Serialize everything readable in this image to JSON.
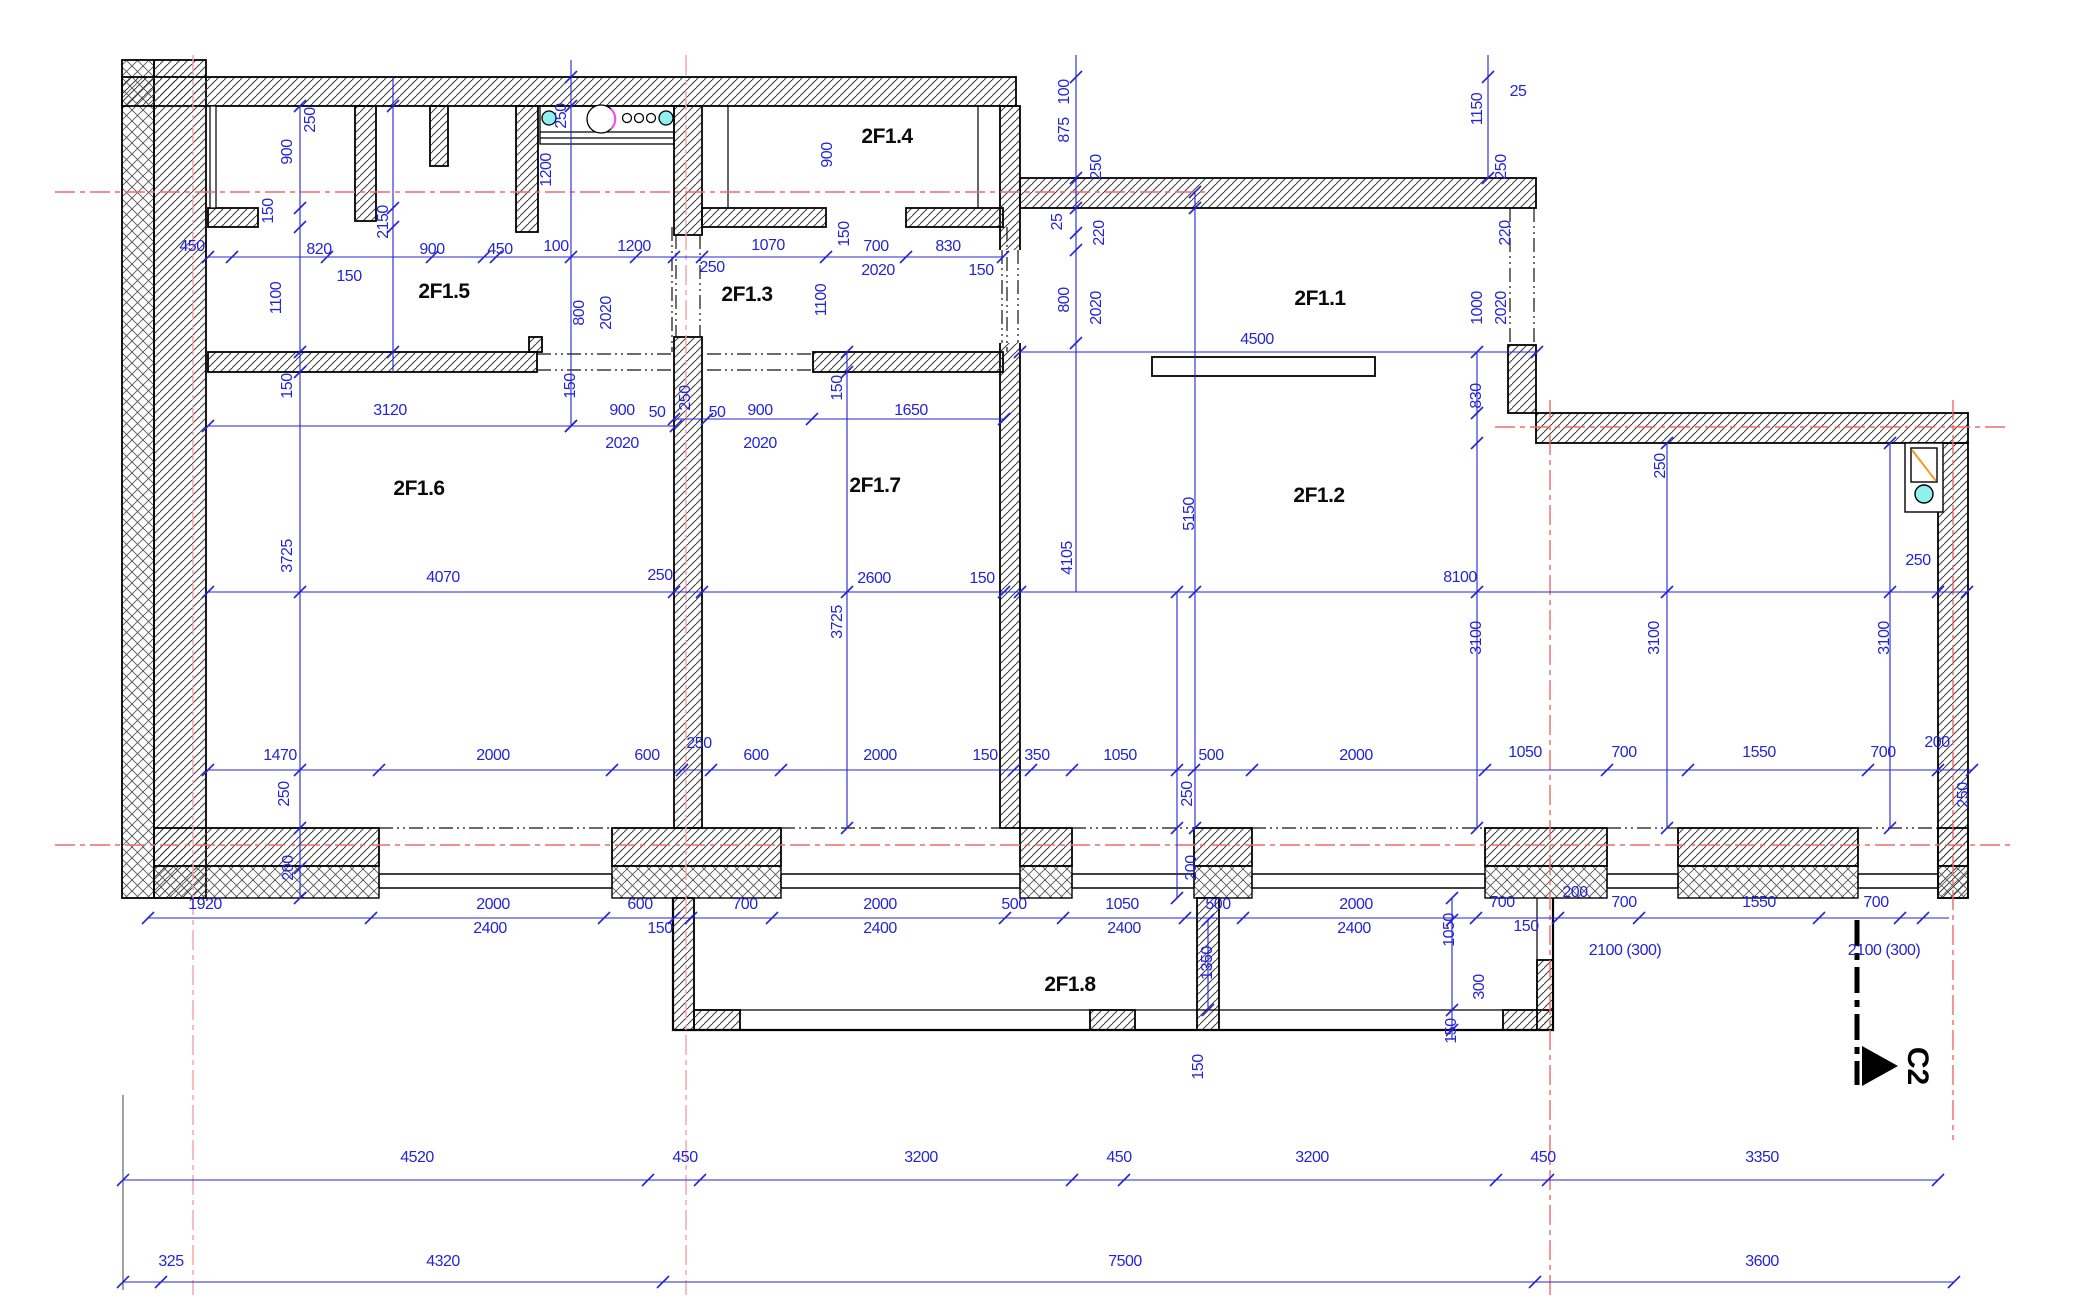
{
  "drawing": {
    "section_marker_label": "C2",
    "room_labels": [
      {
        "name": "2F1.1",
        "x": 1320,
        "y": 299
      },
      {
        "name": "2F1.2",
        "x": 1319,
        "y": 496
      },
      {
        "name": "2F1.3",
        "x": 747,
        "y": 295
      },
      {
        "name": "2F1.4",
        "x": 887,
        "y": 137
      },
      {
        "name": "2F1.5",
        "x": 444,
        "y": 292
      },
      {
        "name": "2F1.6",
        "x": 419,
        "y": 489
      },
      {
        "name": "2F1.7",
        "x": 875,
        "y": 486
      },
      {
        "name": "2F1.8",
        "x": 1070,
        "y": 985
      }
    ],
    "dim_labels": [
      {
        "t": "450",
        "x": 192,
        "y": 247
      },
      {
        "t": "900",
        "x": 288,
        "y": 152,
        "v": 1
      },
      {
        "t": "250",
        "x": 311,
        "y": 120,
        "v": 1
      },
      {
        "t": "150",
        "x": 269,
        "y": 211,
        "v": 1
      },
      {
        "t": "820",
        "x": 319,
        "y": 250
      },
      {
        "t": "150",
        "x": 349,
        "y": 277
      },
      {
        "t": "2150",
        "x": 384,
        "y": 222,
        "v": 1
      },
      {
        "t": "900",
        "x": 432,
        "y": 250
      },
      {
        "t": "450",
        "x": 500,
        "y": 250
      },
      {
        "t": "100",
        "x": 556,
        "y": 247
      },
      {
        "t": "1200",
        "x": 634,
        "y": 247
      },
      {
        "t": "1200",
        "x": 547,
        "y": 170,
        "v": 1
      },
      {
        "t": "250",
        "x": 562,
        "y": 116,
        "v": 1
      },
      {
        "t": "1100",
        "x": 277,
        "y": 298,
        "v": 1
      },
      {
        "t": "250",
        "x": 712,
        "y": 268
      },
      {
        "t": "1070",
        "x": 768,
        "y": 246
      },
      {
        "t": "150",
        "x": 845,
        "y": 234,
        "v": 1
      },
      {
        "t": "700",
        "x": 876,
        "y": 247
      },
      {
        "t": "2020",
        "x": 878,
        "y": 271
      },
      {
        "t": "830",
        "x": 948,
        "y": 247
      },
      {
        "t": "150",
        "x": 981,
        "y": 271
      },
      {
        "t": "900",
        "x": 828,
        "y": 155,
        "v": 1
      },
      {
        "t": "1100",
        "x": 822,
        "y": 300,
        "v": 1
      },
      {
        "t": "800",
        "x": 580,
        "y": 313,
        "v": 1
      },
      {
        "t": "2020",
        "x": 607,
        "y": 313,
        "v": 1
      },
      {
        "t": "150",
        "x": 288,
        "y": 386,
        "v": 1
      },
      {
        "t": "3120",
        "x": 390,
        "y": 411
      },
      {
        "t": "900",
        "x": 622,
        "y": 411
      },
      {
        "t": "50",
        "x": 657,
        "y": 413
      },
      {
        "t": "2020",
        "x": 622,
        "y": 444
      },
      {
        "t": "150",
        "x": 571,
        "y": 386,
        "v": 1
      },
      {
        "t": "4070",
        "x": 443,
        "y": 578
      },
      {
        "t": "250",
        "x": 660,
        "y": 576
      },
      {
        "t": "3725",
        "x": 288,
        "y": 556,
        "v": 1
      },
      {
        "t": "250",
        "x": 686,
        "y": 398,
        "v": 1
      },
      {
        "t": "50",
        "x": 717,
        "y": 413
      },
      {
        "t": "900",
        "x": 760,
        "y": 411
      },
      {
        "t": "2020",
        "x": 760,
        "y": 444
      },
      {
        "t": "150",
        "x": 838,
        "y": 388,
        "v": 1
      },
      {
        "t": "1650",
        "x": 911,
        "y": 411
      },
      {
        "t": "2600",
        "x": 874,
        "y": 579
      },
      {
        "t": "150",
        "x": 982,
        "y": 579
      },
      {
        "t": "3725",
        "x": 838,
        "y": 622,
        "v": 1
      },
      {
        "t": "4105",
        "x": 1068,
        "y": 558,
        "v": 1
      },
      {
        "t": "100",
        "x": 1065,
        "y": 92,
        "v": 1
      },
      {
        "t": "875",
        "x": 1065,
        "y": 130,
        "v": 1
      },
      {
        "t": "250",
        "x": 1097,
        "y": 167,
        "v": 1
      },
      {
        "t": "25",
        "x": 1058,
        "y": 222,
        "v": 1
      },
      {
        "t": "220",
        "x": 1100,
        "y": 233,
        "v": 1
      },
      {
        "t": "800",
        "x": 1065,
        "y": 300,
        "v": 1
      },
      {
        "t": "2020",
        "x": 1097,
        "y": 308,
        "v": 1
      },
      {
        "t": "4500",
        "x": 1257,
        "y": 340
      },
      {
        "t": "1150",
        "x": 1478,
        "y": 109,
        "v": 1
      },
      {
        "t": "25",
        "x": 1518,
        "y": 92
      },
      {
        "t": "250",
        "x": 1502,
        "y": 167,
        "v": 1
      },
      {
        "t": "220",
        "x": 1506,
        "y": 233,
        "v": 1
      },
      {
        "t": "1000",
        "x": 1478,
        "y": 308,
        "v": 1
      },
      {
        "t": "2020",
        "x": 1502,
        "y": 308,
        "v": 1
      },
      {
        "t": "830",
        "x": 1477,
        "y": 396,
        "v": 1
      },
      {
        "t": "250",
        "x": 1661,
        "y": 466,
        "v": 1
      },
      {
        "t": "5150",
        "x": 1190,
        "y": 514,
        "v": 1
      },
      {
        "t": "8100",
        "x": 1460,
        "y": 578
      },
      {
        "t": "250",
        "x": 1918,
        "y": 561
      },
      {
        "t": "3100",
        "x": 1477,
        "y": 638,
        "v": 1
      },
      {
        "t": "3100",
        "x": 1655,
        "y": 638,
        "v": 1
      },
      {
        "t": "3100",
        "x": 1885,
        "y": 638,
        "v": 1
      },
      {
        "t": "1470",
        "x": 280,
        "y": 756
      },
      {
        "t": "2000",
        "x": 493,
        "y": 756
      },
      {
        "t": "600",
        "x": 647,
        "y": 756
      },
      {
        "t": "250",
        "x": 699,
        "y": 744
      },
      {
        "t": "600",
        "x": 756,
        "y": 756
      },
      {
        "t": "2000",
        "x": 880,
        "y": 756
      },
      {
        "t": "150",
        "x": 985,
        "y": 756
      },
      {
        "t": "350",
        "x": 1037,
        "y": 756
      },
      {
        "t": "1050",
        "x": 1120,
        "y": 756
      },
      {
        "t": "500",
        "x": 1211,
        "y": 756
      },
      {
        "t": "2000",
        "x": 1356,
        "y": 756
      },
      {
        "t": "1050",
        "x": 1525,
        "y": 753
      },
      {
        "t": "700",
        "x": 1624,
        "y": 753
      },
      {
        "t": "1550",
        "x": 1759,
        "y": 753
      },
      {
        "t": "700",
        "x": 1883,
        "y": 753
      },
      {
        "t": "200",
        "x": 1937,
        "y": 743
      },
      {
        "t": "250",
        "x": 1964,
        "y": 795,
        "v": 1
      },
      {
        "t": "250",
        "x": 285,
        "y": 794,
        "v": 1
      },
      {
        "t": "200",
        "x": 289,
        "y": 868,
        "v": 1
      },
      {
        "t": "250",
        "x": 1188,
        "y": 794,
        "v": 1
      },
      {
        "t": "200",
        "x": 1192,
        "y": 868,
        "v": 1
      },
      {
        "t": "1920",
        "x": 205,
        "y": 905
      },
      {
        "t": "2000",
        "x": 493,
        "y": 905
      },
      {
        "t": "2400",
        "x": 490,
        "y": 929
      },
      {
        "t": "600",
        "x": 640,
        "y": 905
      },
      {
        "t": "150",
        "x": 660,
        "y": 929
      },
      {
        "t": "700",
        "x": 745,
        "y": 905
      },
      {
        "t": "2000",
        "x": 880,
        "y": 905
      },
      {
        "t": "2400",
        "x": 880,
        "y": 929
      },
      {
        "t": "500",
        "x": 1014,
        "y": 905
      },
      {
        "t": "1050",
        "x": 1122,
        "y": 905
      },
      {
        "t": "2400",
        "x": 1124,
        "y": 929
      },
      {
        "t": "500",
        "x": 1218,
        "y": 905
      },
      {
        "t": "2000",
        "x": 1356,
        "y": 905
      },
      {
        "t": "2400",
        "x": 1354,
        "y": 929
      },
      {
        "t": "1050",
        "x": 1450,
        "y": 930,
        "v": 1
      },
      {
        "t": "700",
        "x": 1502,
        "y": 903
      },
      {
        "t": "150",
        "x": 1526,
        "y": 927
      },
      {
        "t": "200",
        "x": 1575,
        "y": 893
      },
      {
        "t": "700",
        "x": 1624,
        "y": 903
      },
      {
        "t": "1550",
        "x": 1759,
        "y": 903
      },
      {
        "t": "700",
        "x": 1876,
        "y": 903
      },
      {
        "t": "2100 (300)",
        "x": 1625,
        "y": 951
      },
      {
        "t": "2100 (300)",
        "x": 1884,
        "y": 951
      },
      {
        "t": "1350",
        "x": 1208,
        "y": 963,
        "v": 1
      },
      {
        "t": "300",
        "x": 1480,
        "y": 987,
        "v": 1
      },
      {
        "t": "150",
        "x": 1452,
        "y": 1031,
        "v": 1
      },
      {
        "t": "150",
        "x": 1199,
        "y": 1067,
        "v": 1
      },
      {
        "t": "4520",
        "x": 417,
        "y": 1158
      },
      {
        "t": "450",
        "x": 685,
        "y": 1158
      },
      {
        "t": "3200",
        "x": 921,
        "y": 1158
      },
      {
        "t": "450",
        "x": 1119,
        "y": 1158
      },
      {
        "t": "3200",
        "x": 1312,
        "y": 1158
      },
      {
        "t": "450",
        "x": 1543,
        "y": 1158
      },
      {
        "t": "3350",
        "x": 1762,
        "y": 1158
      },
      {
        "t": "325",
        "x": 171,
        "y": 1262
      },
      {
        "t": "4320",
        "x": 443,
        "y": 1262
      },
      {
        "t": "7500",
        "x": 1125,
        "y": 1262
      },
      {
        "t": "3600",
        "x": 1762,
        "y": 1262
      }
    ],
    "colors": {
      "dimension_blue": "#2424d6",
      "axis_red": "#ef6a6a",
      "axis_pale_red": "#f2a2a2",
      "fixture_orange": "#f59a23",
      "fixture_cyan": "#8ff0f0",
      "fixture_magenta": "#f050f0"
    }
  }
}
